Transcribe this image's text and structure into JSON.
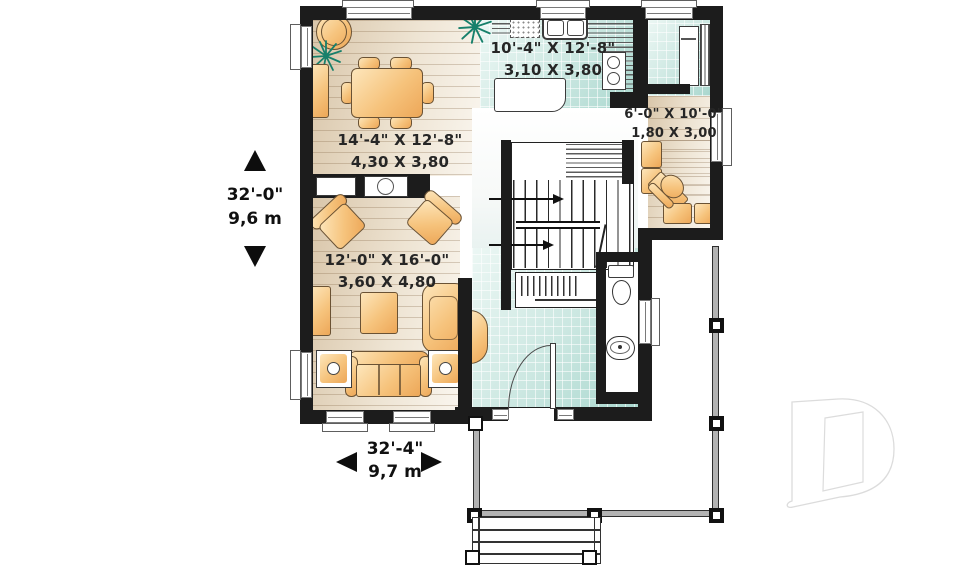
{
  "plan": {
    "rooms": [
      {
        "id": "dining-room",
        "imperial": "14'-4\" X 12'-8\"",
        "metric": "4,30 X 3,80"
      },
      {
        "id": "kitchen",
        "imperial": "10'-4\" X 12'-8\"",
        "metric": "3,10 X 3,80"
      },
      {
        "id": "den",
        "imperial": "6'-0\" X 10'-0\"",
        "metric": "1,80 X 3,00"
      },
      {
        "id": "living-room",
        "imperial": "12'-0\" X 16'-0\"",
        "metric": "3,60 X 4,80"
      }
    ],
    "overall": {
      "height_imperial": "32'-0\"",
      "height_metric": "9,6 m",
      "width_imperial": "32'-4\"",
      "width_metric": "9,7 m"
    },
    "watermark_letter": "D",
    "colors": {
      "wall": "#1c1c1c",
      "wood_floor": "#e9dcc6",
      "tile_floor": "#cde7e1",
      "furniture": "#f6c37c",
      "plant": "#17806b"
    }
  }
}
